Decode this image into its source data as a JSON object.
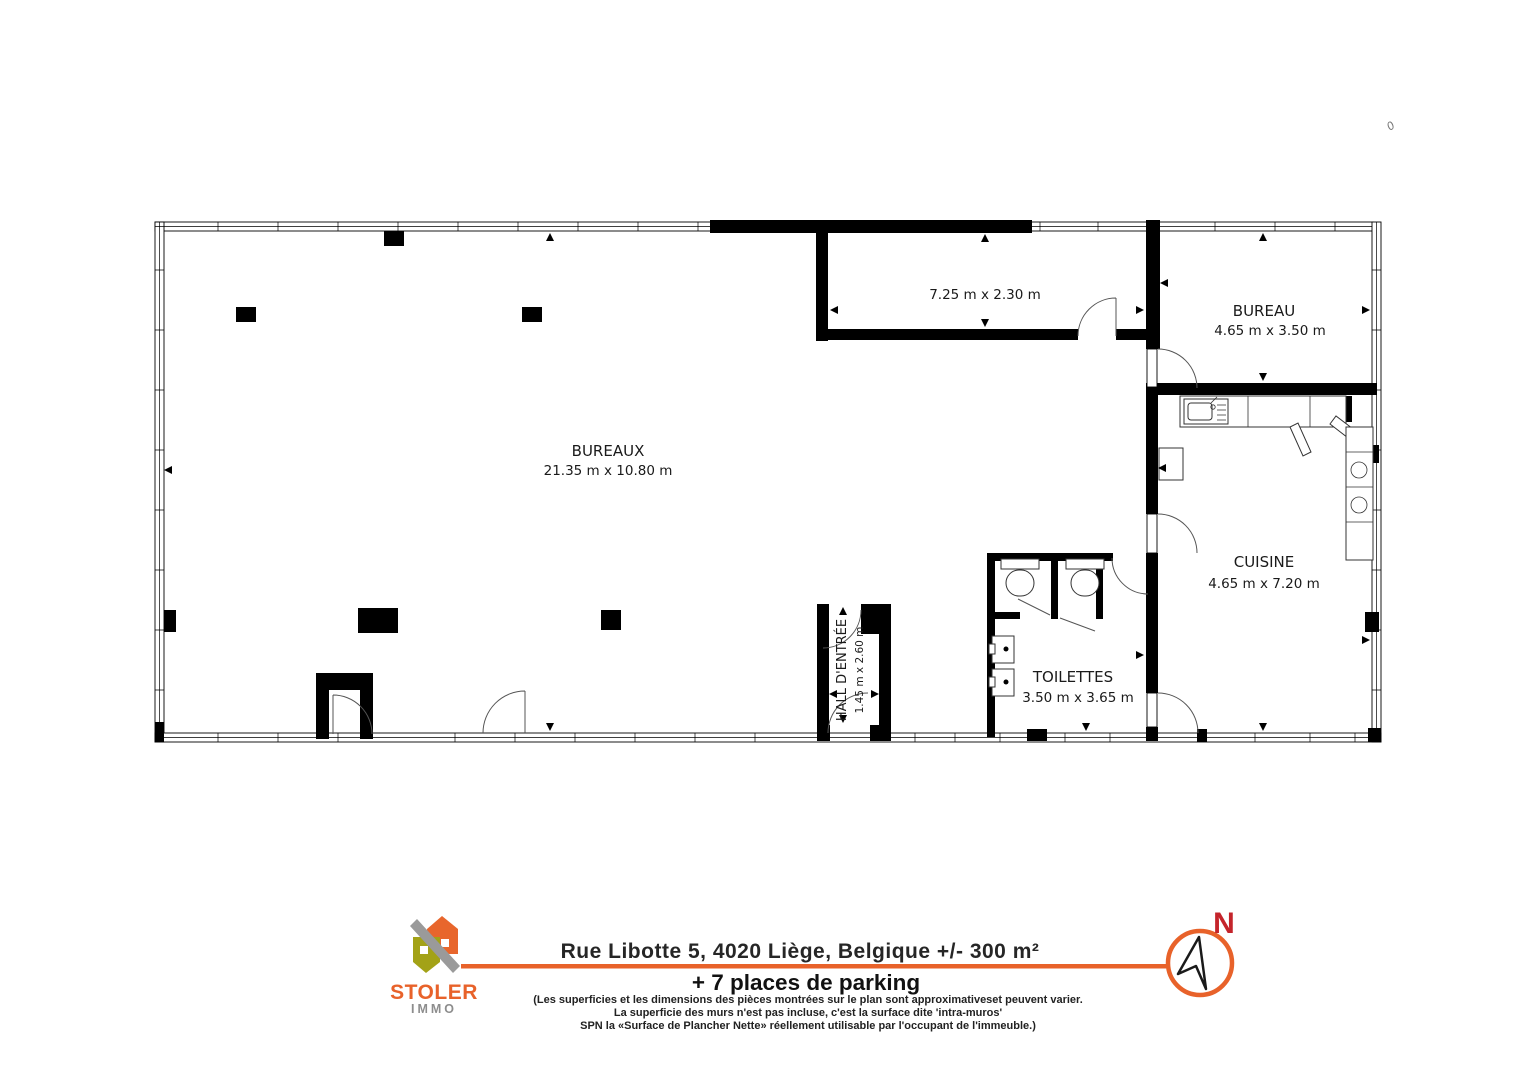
{
  "plan": {
    "rooms": {
      "bureaux": {
        "label": "BUREAUX",
        "dims": "21.35 m x 10.80 m"
      },
      "storage": {
        "dims": "7.25 m x 2.30 m"
      },
      "bureau": {
        "label": "BUREAU",
        "dims": "4.65 m x 3.50 m"
      },
      "cuisine": {
        "label": "CUISINE",
        "dims": "4.65 m x 7.20 m"
      },
      "toilettes": {
        "label": "TOILETTES",
        "dims": "3.50 m x 3.65 m"
      },
      "hall": {
        "label": "HALL D'ENTRÉE",
        "dims": "1.45 m x 2.60 m"
      }
    },
    "stray_mark": "0"
  },
  "footer": {
    "brand": {
      "name": "STOLER",
      "sub": "IMMO"
    },
    "address": "Rue Libotte 5, 4020 Liège, Belgique +/- 300 m²",
    "parking": "+ 7 places de parking",
    "disclaimer": [
      "(Les superficies et les dimensions des pièces montrées sur le plan sont approximativeset peuvent varier.",
      "La superficie des murs n'est pas incluse, c'est la surface dite 'intra-muros'",
      "SPN la «Surface de Plancher Nette» réellement utilisable par l'occupant de l'immeuble.)"
    ],
    "compass": {
      "label": "N"
    },
    "colors": {
      "accent": "#E8622A",
      "north": "#C4242B",
      "olive": "#A3A217",
      "gray": "#9A9A9A"
    }
  }
}
